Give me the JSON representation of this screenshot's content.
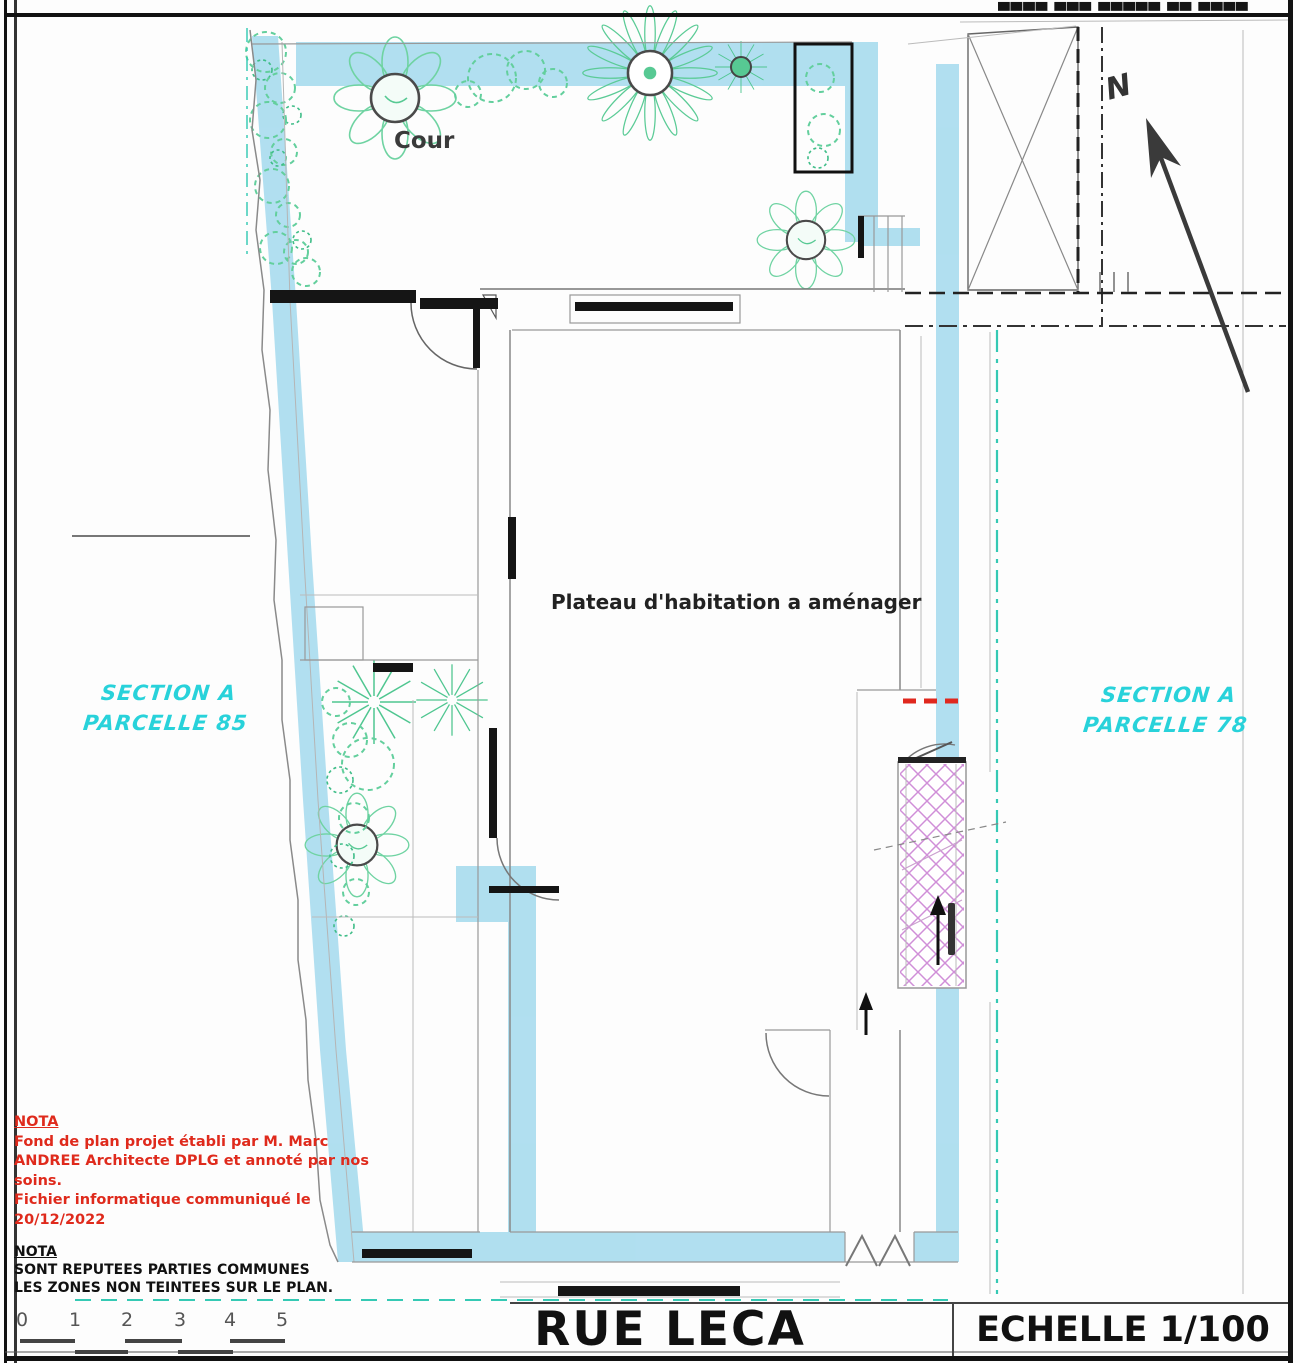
{
  "header": {
    "clipped_text": "▄▄▄▄ ▄▄▄ ▄▄▄▄▄ ▄▄ ▄▄▄▄▄▄▄"
  },
  "plan": {
    "courtyard_label": "Cour",
    "main_area_label": "Plateau d'habitation a aménager",
    "parcel_left": {
      "line1": "SECTION A",
      "line2": "PARCELLE 85"
    },
    "parcel_right": {
      "line1": "SECTION A",
      "line2": "PARCELLE 78"
    },
    "north_label": "N"
  },
  "notes": {
    "red_nota": {
      "title": "NOTA",
      "lines": [
        "Fond de plan projet établi par M. Marc",
        "ANDREE Architecte DPLG et annoté par nos",
        "soins.",
        "Fichier informatique communiqué le",
        "20/12/2022"
      ]
    },
    "black_nota": {
      "title": "NOTA",
      "lines": [
        "SONT REPUTEES PARTIES COMMUNES",
        "LES ZONES NON TEINTEES SUR LE PLAN."
      ]
    }
  },
  "title_block": {
    "street_name": "RUE LECA",
    "scale_label": "ECHELLE 1/100"
  },
  "scale_bar": {
    "ticks": [
      "0",
      "1",
      "2",
      "3",
      "4",
      "5"
    ]
  },
  "colors": {
    "wall_highlight": "#a6dbee",
    "vegetation_green": "#57c993",
    "parcel_label_cyan": "#28d2da",
    "nota_red": "#df2a1c",
    "stair_hatch_magenta": "#d08fd8",
    "boundary_teal": "#35c9b4",
    "red_dashed": "#e0281e"
  }
}
